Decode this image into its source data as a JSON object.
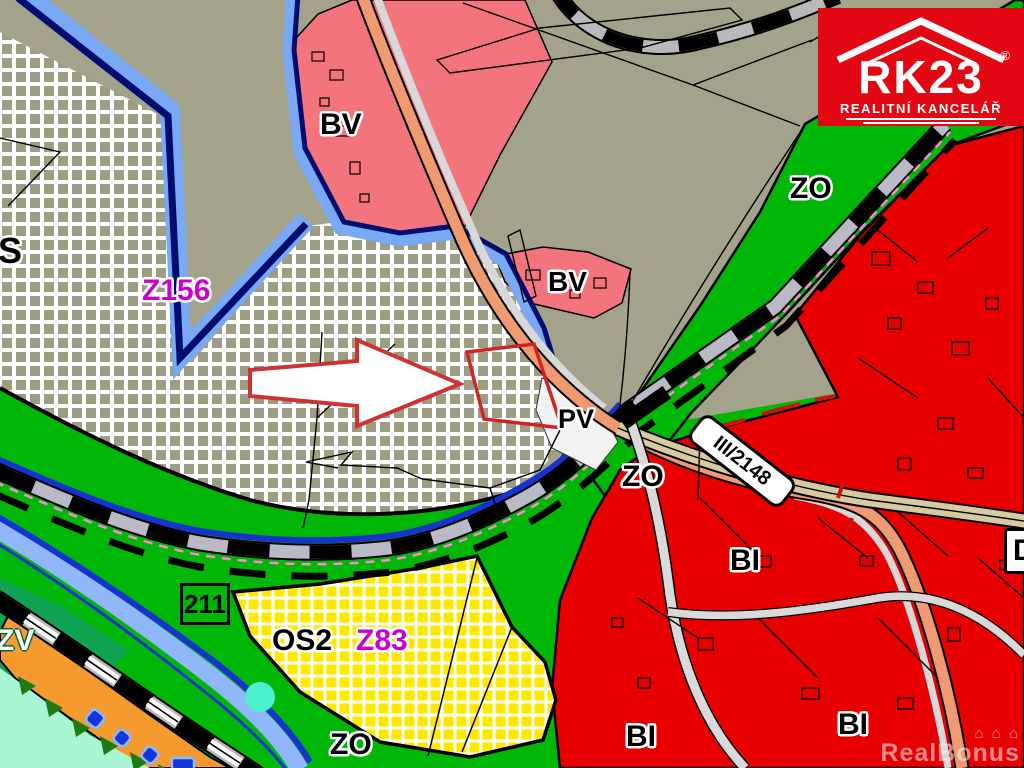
{
  "map": {
    "labels": {
      "s": "S",
      "z156": "Z156",
      "bv_top": "BV",
      "bv_mid": "BV",
      "zo_topright": "ZO",
      "zo_center": "ZO",
      "zo_bottom": "ZO",
      "pv": "PV",
      "os2": "OS2",
      "z83": "Z83",
      "bi_center": "BI",
      "bi_bottom_left": "BI",
      "bi_bottom_right": "BI",
      "zv": "ZV",
      "d": "D"
    },
    "signs": {
      "route_211": "211",
      "route_iii_2148": "III/2148"
    },
    "logo": {
      "brand": "RK23",
      "tagline": "REALITNÍ KANCELÁŘ",
      "registered": "®",
      "bg_color": "#e30613"
    },
    "watermark": {
      "text": "RealBonus",
      "houses": "⌂ ⌂ ⌂"
    },
    "colors": {
      "olive": "#a3a38b",
      "checker_olive": "#9d9d84",
      "green": "#00b606",
      "dark_green_zv": "#0fa352",
      "red": "#e80000",
      "pink_bv": "#f4747e",
      "yellow": "#ffe800",
      "orange": "#f59a2e",
      "aqua": "#a9f6d3",
      "light_blue": "#8fb7fa",
      "blue": "#1633d2",
      "navy": "#000d70",
      "salmon_road": "#ef9a70",
      "tan_road": "#d6cba0",
      "rail_gray": "#b9b9b9",
      "road_gray": "#d9d9d9",
      "magenta": "#cf00cf",
      "dash_pink": "#ff85d6",
      "plot_outline_red": "#d42222"
    }
  }
}
